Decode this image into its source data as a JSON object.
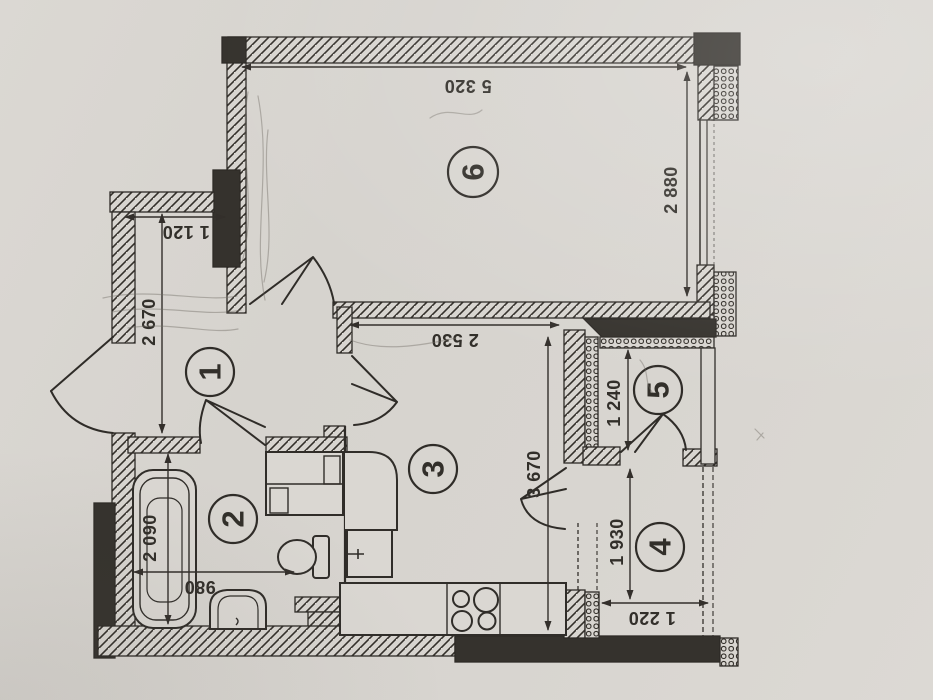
{
  "plan": {
    "rooms": [
      {
        "key": "hallway",
        "number": "1"
      },
      {
        "key": "bathroom",
        "number": "2"
      },
      {
        "key": "kitchen",
        "number": "3"
      },
      {
        "key": "balcony",
        "number": "4"
      },
      {
        "key": "loggia",
        "number": "5"
      },
      {
        "key": "living-room",
        "number": "6"
      }
    ],
    "dimensions": {
      "living_width": "5 320",
      "living_depth": "2 880",
      "closet_width": "1 120",
      "hall_depth": "2 670",
      "kitchen_width": "2 530",
      "kitchen_depth": "3 670",
      "loggia_depth": "1 240",
      "balcony_depth": "1 930",
      "balcony_width": "1 220",
      "bathtub_length": "2 090",
      "bath_width": "980"
    },
    "colors": {
      "ink": "#332f2b",
      "paper": "#d8d5d0",
      "wall_dark": "#35322d"
    }
  }
}
